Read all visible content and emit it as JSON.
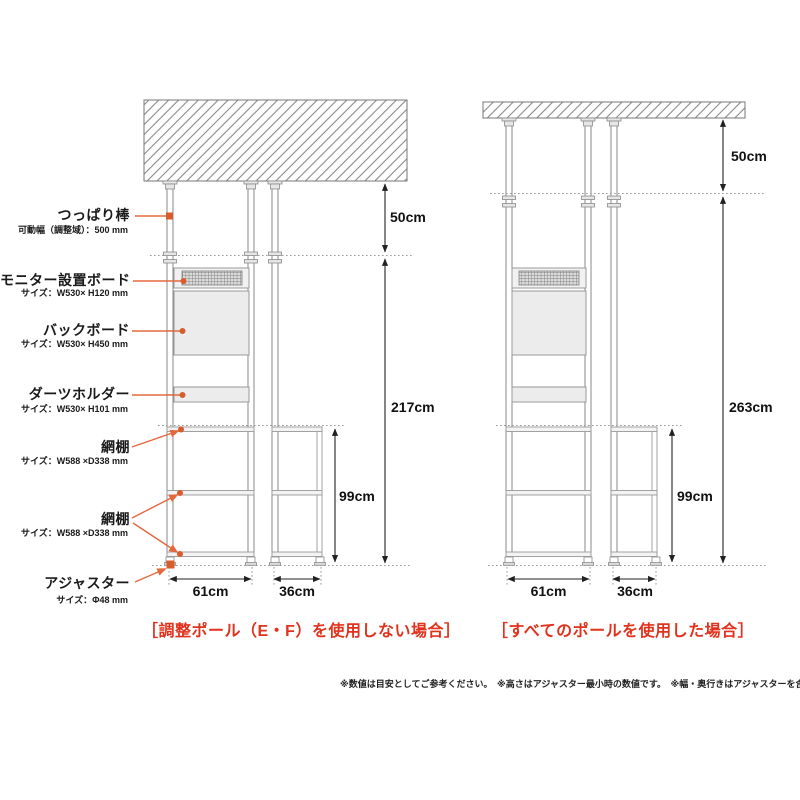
{
  "colors": {
    "leader_orange": "#E4683C",
    "dot_orange": "#D85C2C",
    "caption_red": "#E0321C",
    "structure_gray": "#999999",
    "dimension_black": "#222222",
    "board_fill": "#ECECEC"
  },
  "parts": {
    "tension_rod": {
      "label": "つっぱり棒",
      "spec": "可動幅（調整域）：500 mm"
    },
    "monitor_board": {
      "label": "モニター設置ボード",
      "spec": "サイズ：W530× H120 mm"
    },
    "back_board": {
      "label": "バックボード",
      "spec": "サイズ：W530× H450 mm"
    },
    "darts_holder": {
      "label": "ダーツホルダー",
      "spec": "サイズ：W530× H101 mm"
    },
    "mesh_shelf_upper": {
      "label": "網棚",
      "spec": "サイズ：W588 ×D338 mm"
    },
    "mesh_shelf_lower": {
      "label": "網棚",
      "spec": "サイズ：W588 ×D338 mm"
    },
    "adjuster": {
      "label": "アジャスター",
      "spec": "サイズ：Φ48 mm"
    }
  },
  "left_view": {
    "caption": "［調整ポール（E・F）を使用しない場合］",
    "ceiling_gap": "50cm",
    "total_height": "217cm",
    "shelf_height": "99cm",
    "main_width": "61cm",
    "side_width": "36cm"
  },
  "right_view": {
    "caption": "［すべてのポールを使用した場合］",
    "ceiling_gap": "50cm",
    "total_height": "263cm",
    "shelf_height": "99cm",
    "main_width": "61cm",
    "side_width": "36cm"
  },
  "footnote": "※数値は目安としてご参考ください。　※高さはアジャスター最小時の数値です。　※幅・奥行きはアジャスターを含む数値です。"
}
